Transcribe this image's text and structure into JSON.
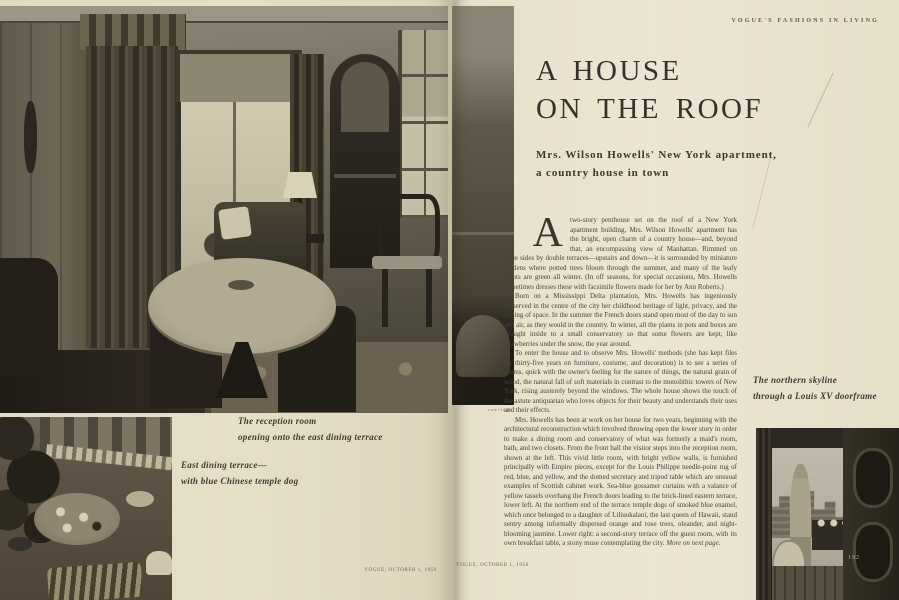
{
  "left_page": {
    "captions": {
      "reception": [
        "The reception room",
        "opening onto the east dining terrace"
      ],
      "terrace": [
        "East dining terrace—",
        "with blue Chinese temple dog"
      ]
    },
    "footer": "VOGUE, OCTOBER 1, 1956"
  },
  "right_page": {
    "eyebrow": "VOGUE'S FASHIONS IN LIVING",
    "headline": [
      "A HOUSE",
      "ON THE ROOF"
    ],
    "subtitle": [
      "Mrs. Wilson Howells' New York apartment,",
      "a country house in town"
    ],
    "article": {
      "drop_cap": "A",
      "paragraphs": [
        "two-story penthouse set on the roof of a New York apartment building, Mrs. Wilson Howells' apartment has the bright, open charm of a country house—and, beyond that, an encompassing view of Manhattan. Rimmed on three sides by double terraces—upstairs and down—it is surrounded by miniature gardens where potted trees bloom through the summer, and many of the leafy plants are green all winter. (In off seasons, for special occasions, Mrs. Howells sometimes dresses these with facsimile flowers made for her by Ann Roberts.)",
        "Born on a Mississippi Delta plantation, Mrs. Howells has ingeniously preserved in the centre of the city her childhood heritage of light, privacy, and the feeling of space. In the summer the French doors stand open most of the day to sun and air, as they would in the country. In winter, all the plants in pots and boxes are brought inside to a small conservatory so that some flowers are kept, like strawberries under the snow, the year around.",
        "To enter the house and to observe Mrs. Howells' methods (she has kept files for thirty-five years on furniture, costume, and decoration) is to see a series of rooms, quick with the owner's feeling for the nature of things, the natural grain of wood, the natural fall of soft materials in contrast to the monolithic towers of New York, rising austerely beyond the windows. The whole house shows the touch of the astute antiquarian who loves objects for their beauty and understands their uses and their effects.",
        "Mrs. Howells has been at work on her house for two years, beginning with the architectural reconstruction which involved throwing open the lower story in order to make a dining room and conservatory of what was formerly a maid's room, bath, and two closets. From the front hall the visitor steps into the reception room, shown at the left. This vivid little room, with bright yellow walls, is furnished principally with Empire pieces, except for the Louis Philippe needle-point rug of red, blue, and yellow, and the domed secretary and tripod table which are unusual examples of Scottish cabinet work. Sea-blue gossamer curtains with a valance of yellow tassels overhang the French doors leading to the brick-lined eastern terrace, lower left. At the northern end of the terrace temple dogs of smoked blue enamel, which once belonged to a daughter of Liliuokalani, the last queen of Hawaii, stand sentry among informally dispersed orange and rose trees, oleander, and night-blooming jasmine. Lower right: a second-story terrace off the guest room, with its own breakfast table, a stony muse contemplating the city."
      ],
      "more_note": "More on next page."
    },
    "caption_skyline": [
      "The northern skyline",
      "through a Louis XV doorframe"
    ],
    "credit": "rawlings",
    "footer": "VOGUE, OCTOBER 1, 1956",
    "page_number": "192"
  },
  "colors": {
    "paper_left": "#e4ddc6",
    "paper_right": "#e9e2cf",
    "ink": "#3f3b33",
    "photo_light": "#c9c1a8",
    "photo_dark": "#2a2620"
  }
}
